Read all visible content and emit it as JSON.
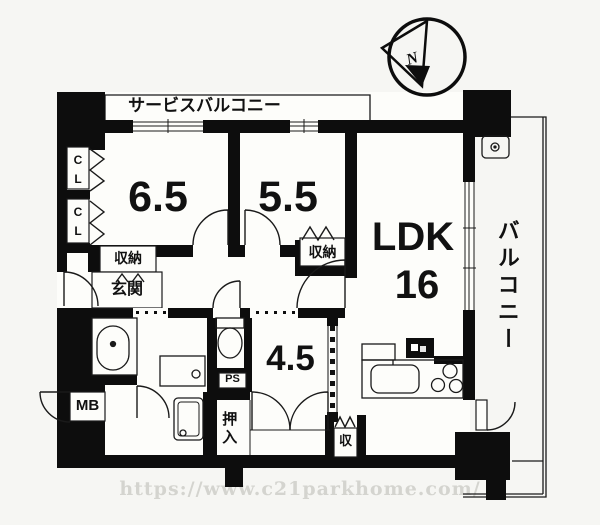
{
  "palette": {
    "wall": "#0d0d0d",
    "floor": "#fdfdfa",
    "background": "#f6f6f3",
    "line": "#1a1a1a",
    "watermark_color": "#d4d4cf"
  },
  "compass": {
    "north": "N"
  },
  "balconies": {
    "service": "サービスバルコニー",
    "main": "バルコニー"
  },
  "rooms": {
    "western1": "6.5",
    "western2": "5.5",
    "ldk": "LDK",
    "ldk_size": "16",
    "japanese": "4.5"
  },
  "closets": {
    "cl": "C\nL",
    "hall_storage": "収納",
    "bedroom_storage": "収納",
    "oshiire": "押入",
    "small_storage": "収"
  },
  "service_areas": {
    "entrance": "玄関",
    "meter_box": "MB",
    "pipe_space": "PS"
  },
  "watermark": "https://www.c21parkhome.com/"
}
